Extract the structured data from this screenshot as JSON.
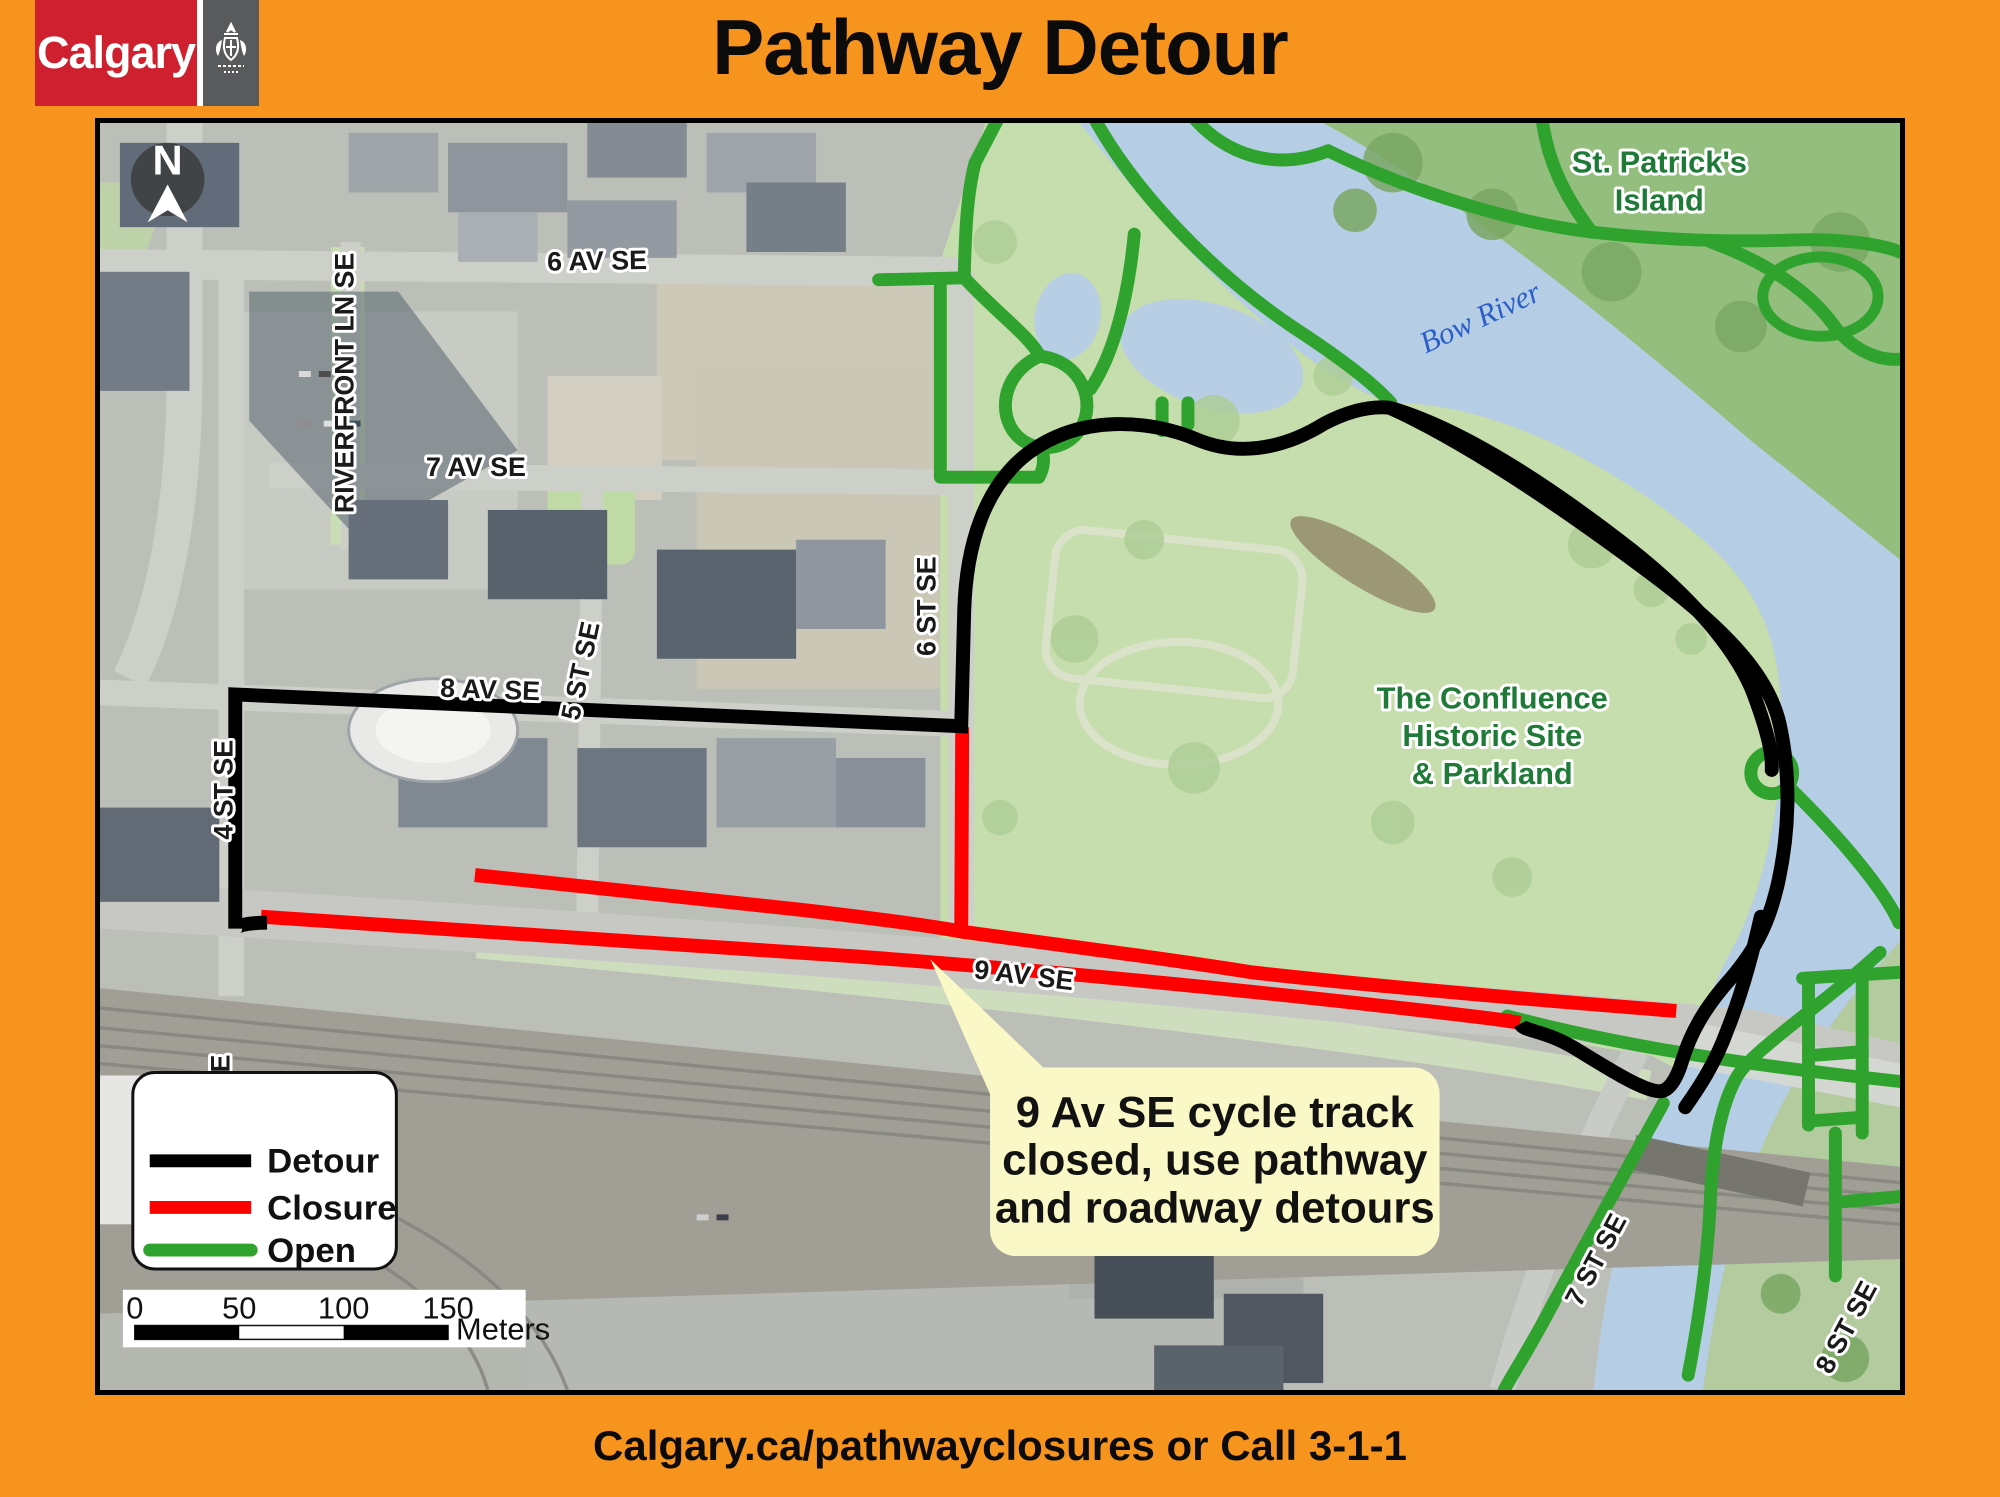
{
  "header": {
    "brand_wordmark": "Calgary",
    "title": "Pathway Detour"
  },
  "footer": {
    "text": "Calgary.ca/pathwayclosures or Call 3-1-1"
  },
  "map": {
    "north_arrow": {
      "label": "N"
    },
    "street_labels": [
      {
        "id": "6-av-se",
        "text": "6 AV SE"
      },
      {
        "id": "7-av-se",
        "text": "7 AV SE"
      },
      {
        "id": "8-av-se",
        "text": "8 AV SE"
      },
      {
        "id": "9-av-se",
        "text": "9 AV SE"
      },
      {
        "id": "riverfront-ln-se",
        "text": "RIVERFRONT LN SE"
      },
      {
        "id": "4-st-se",
        "text": "4 ST SE"
      },
      {
        "id": "5-st-se",
        "text": "5 ST SE"
      },
      {
        "id": "6-st-se",
        "text": "6 ST SE"
      },
      {
        "id": "7-st-se",
        "text": "7 ST SE"
      },
      {
        "id": "8-st-se",
        "text": "8 ST SE"
      },
      {
        "id": "partial-street-e",
        "text": "E"
      }
    ],
    "place_labels": {
      "st_patricks_island": {
        "line1": "St. Patrick's",
        "line2": "Island"
      },
      "bow_river": {
        "text": "Bow River"
      },
      "confluence": {
        "line1": "The Confluence",
        "line2": "Historic Site",
        "line3": "& Parkland"
      }
    },
    "callout": {
      "line1": "9 Av SE cycle track",
      "line2": "closed, use pathway",
      "line3": "and roadway detours"
    },
    "legend": {
      "items": [
        {
          "label": "Detour",
          "color": "#000000"
        },
        {
          "label": "Closure",
          "color": "#FF0000"
        },
        {
          "label": "Open",
          "color": "#2FA32E"
        }
      ]
    },
    "scale_bar": {
      "ticks": [
        "0",
        "50",
        "100",
        "150"
      ],
      "unit": "Meters"
    }
  },
  "colors": {
    "frame_orange": "#F7941E",
    "logo_red": "#CF2030",
    "logo_gray": "#595A5C",
    "detour_black": "#000000",
    "closure_red": "#FF0000",
    "open_green": "#2FA32E",
    "river_blue": "#B3CCE4",
    "park_green": "#C3DCA9",
    "island_green": "#8FBB77",
    "bow_river_label_blue": "#2B5FC7",
    "park_label_green": "#1F7A38",
    "callout_yellow": "#FAF8C6"
  }
}
